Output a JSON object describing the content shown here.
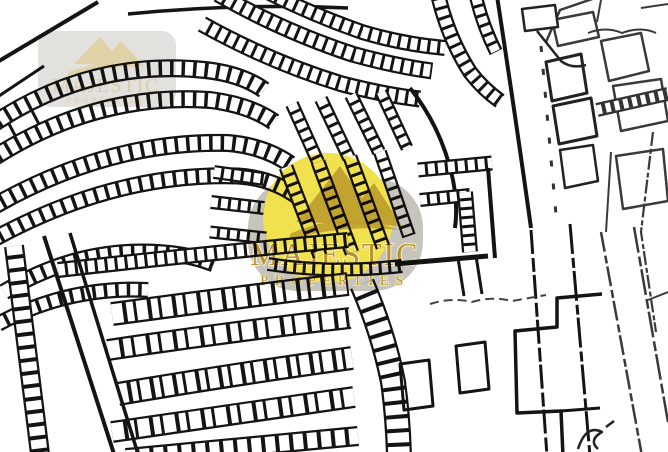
{
  "watermark": {
    "line1": "MAJESTIC",
    "line2": "PROPERTIES",
    "icon": "mountain-peaks-icon",
    "instances": [
      {
        "position": "top-left",
        "style": "faint-badge"
      },
      {
        "position": "center",
        "style": "badge-with-yellow-circle-highlight"
      }
    ]
  },
  "palette": {
    "background": "#ffffff",
    "map_line": "#141414",
    "sketch_line": "#3a3a3a",
    "highlight_yellow": "#f2e14f",
    "badge_gray": "#c7c3bd",
    "logo_gold": "#b8922e",
    "logo_gold_dark": "#bd9c2c",
    "brand_outline": "#f8f2cc"
  }
}
